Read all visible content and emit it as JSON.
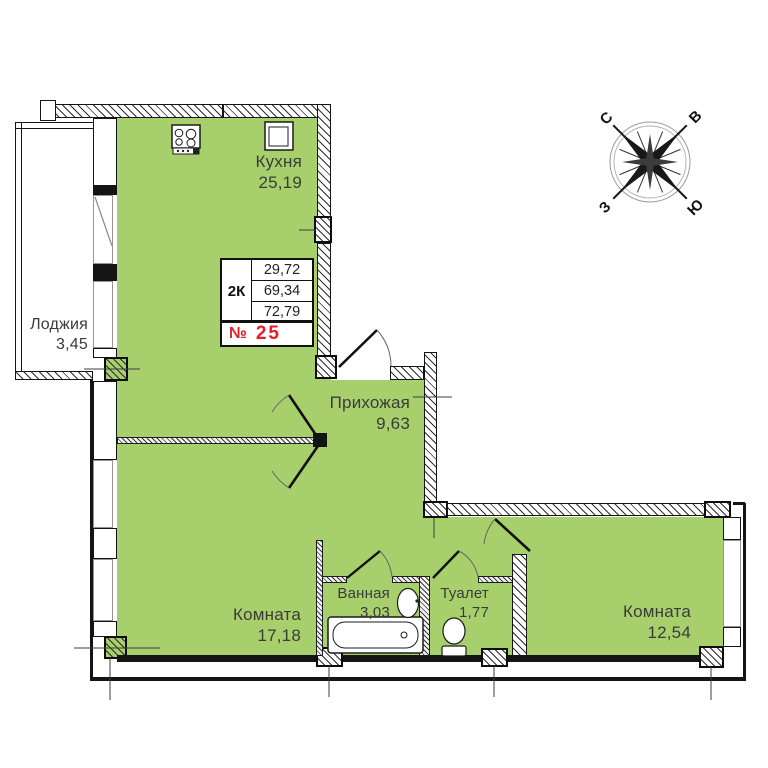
{
  "plan": {
    "rooms": [
      {
        "name": "Кухня",
        "area": "25,19"
      },
      {
        "name": "Лоджия",
        "area": "3,45"
      },
      {
        "name": "Прихожая",
        "area": "9,63"
      },
      {
        "name": "Комната",
        "area": "17,18"
      },
      {
        "name": "Ванная",
        "area": "3,03"
      },
      {
        "name": "Туалет",
        "area": "1,77"
      },
      {
        "name": "Комната",
        "area": "12,54"
      }
    ],
    "info_box": {
      "type": "2К",
      "area_row_1": "29,72",
      "area_row_2": "69,34",
      "area_row_3": "72,79",
      "number_sign": "№",
      "apartment_number": "25"
    },
    "compass": {
      "north": "С",
      "east": "В",
      "west": "З",
      "south": "Ю"
    }
  },
  "icons": {
    "stove": "stove-icon",
    "kitchen_shaft": "sink-square-icon",
    "bathtub": "bathtub-icon",
    "washbasin": "washbasin-icon",
    "toilet_bowl": "wc-icon",
    "compass_rose": "compass-rose-icon"
  },
  "colors": {
    "floor": "#a7d06d",
    "wall": "#141414",
    "number_red": "#e31e24",
    "window_frame": "#949494",
    "text": "#3b3b3b"
  }
}
